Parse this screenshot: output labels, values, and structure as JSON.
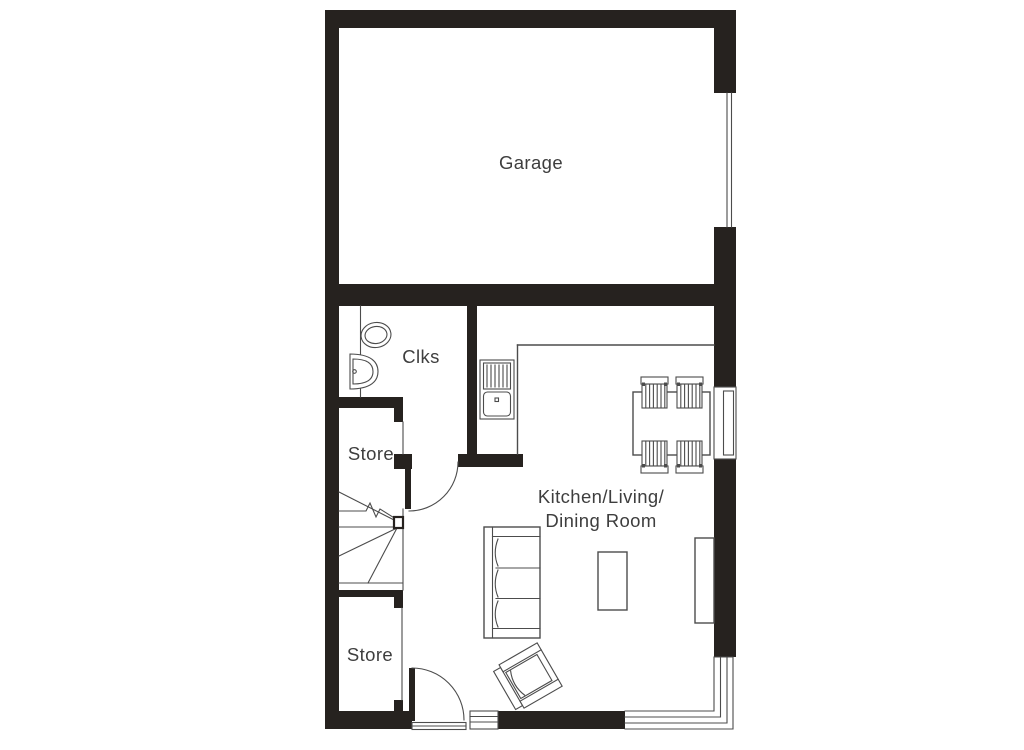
{
  "plan": {
    "rooms": {
      "garage": {
        "label": "Garage"
      },
      "cloakroom": {
        "label": "Clks"
      },
      "store_top": {
        "label": "Store"
      },
      "kitchen_living_dining": {
        "line1": "Kitchen/Living/",
        "line2": "Dining Room"
      },
      "store_bottom": {
        "label": "Store"
      }
    },
    "colors": {
      "wall": "#26221f",
      "line": "#4c4c4c",
      "text": "#3e3e3e",
      "background": "#ffffff"
    }
  }
}
